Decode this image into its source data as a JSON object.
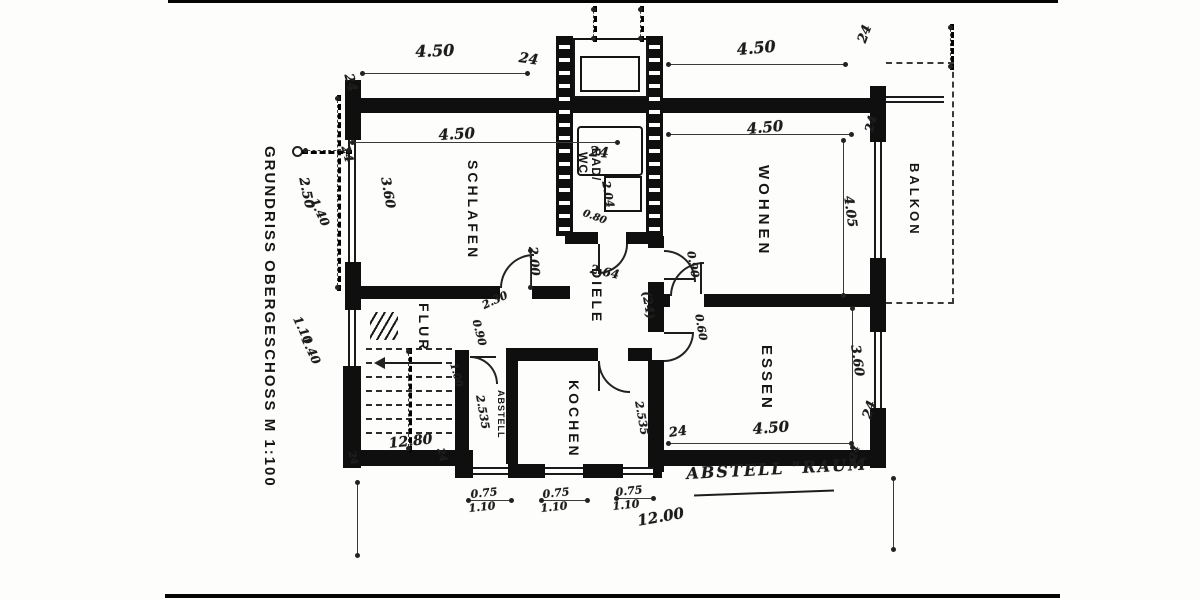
{
  "document": {
    "title": "GRUNDRISS OBERGESCHOSS  M 1:100"
  },
  "rooms": {
    "schlafen": "SCHLAFEN",
    "bad": "BAD/",
    "wc": "WC",
    "wohnen": "WOHNEN",
    "balkon": "BALKON",
    "diele": "DIELE",
    "flur": "FLUR",
    "abstell": "ABSTELL",
    "kochen": "KOCHEN",
    "essen": "ESSEN"
  },
  "annotations": {
    "abstellraum": "ABSTELL \"RAUM"
  },
  "dims": {
    "top450a": "4.50",
    "top24a": "24",
    "top24b": "24",
    "top450b": "4.50",
    "top24c": "24",
    "low450a": "4.50",
    "low24a": "24",
    "low24b": "24",
    "low450b": "4.50",
    "low24c": "24",
    "schl360": "3.60",
    "schl200": "2.00",
    "bad204": "2.04",
    "bad080": "0.80",
    "diele264": "2.64",
    "diele24": "(24)",
    "wohnendoor090": "0.90",
    "wohnen405": "4.05",
    "essen360": "3.60",
    "essendoor060": "0.60",
    "essen450": "4.50",
    "essen24a": "24",
    "essen24b": "24",
    "essen24c": "24",
    "flur230": "2.30",
    "flur090": "0.90",
    "flur1280": "12.80",
    "flur24a": "24",
    "flur24b": "24",
    "abstell2535": "2.535",
    "kochen2535": "2.535",
    "abstell100": "1.00",
    "win1a": "0.75",
    "win1b": "1.10",
    "win2a": "0.75",
    "win2b": "1.10",
    "win3a": "0.75",
    "win3b": "1.10",
    "total1200": "12.00",
    "left250": "2.50",
    "left140a": "1.40",
    "left110": "1.10",
    "left140b": "1.40"
  }
}
